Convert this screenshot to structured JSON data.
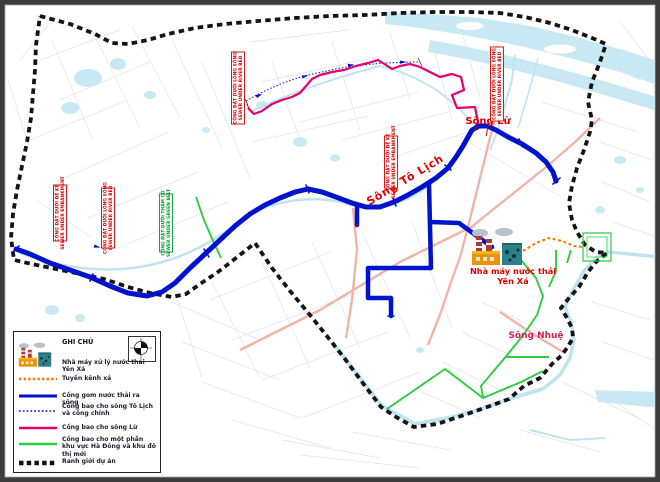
{
  "map": {
    "labels": {
      "song_to_lich": "Sông Tô Lịch",
      "song_lu": "Sông Lừ",
      "song_nhue": "Sông Nhuệ",
      "plant_line1": "Nhà máy nước thải",
      "plant_line2": "Yên Xá"
    },
    "annotations": [
      {
        "line1": "CỐNG ĐẶT DƯỚI LÒNG SÔNG",
        "line2": "SEWER UNDER RIVER BED",
        "color": "red"
      },
      {
        "line1": "CỐNG ĐẶT DƯỚI ĐÊ KÈ",
        "line2": "SEWER UNDER EMBANKMENT",
        "color": "red"
      },
      {
        "line1": "CỐNG ĐẶT DƯỚI LÒNG SÔNG",
        "line2": "SEWER UNDER RIVER BED",
        "color": "red"
      },
      {
        "line1": "CỐNG ĐẶT DƯỚI THẢM CỎ",
        "line2": "SEWER UNDER GREEN BELT",
        "color": "green"
      },
      {
        "line1": "CỐNG ĐẶT DƯỚI ĐÊ KÈ",
        "line2": "SEWER UNDER EMBANKMENT",
        "color": "red"
      },
      {
        "line1": "CỐNG ĐẶT DƯỚI LÒNG SÔNG",
        "line2": "SEWER UNDER RIVER BED",
        "color": "red"
      }
    ],
    "colors": {
      "main_sewer": "#0013cc",
      "lu_interceptor": "#e5006e",
      "green_interceptor": "#2ecc40",
      "discharge_channel": "#ff7300",
      "project_boundary": "#141414",
      "river_label": "#e20000",
      "nhue_label": "#cc2255",
      "water": "#c8e9f4",
      "major_road": "#f0b3aa"
    }
  },
  "legend": {
    "title": "GHI CHÚ",
    "items": [
      {
        "key": "plant",
        "label": "Nhà máy xử lý nước thải Yên Xá"
      },
      {
        "key": "discharge-channel",
        "label": "Tuyến kênh xả"
      },
      {
        "key": "main-sewer",
        "label": "Cống gom nước thải ra sông"
      },
      {
        "key": "to-lich-interceptor",
        "label": "Cống bao cho sông Tô Lịch và cống chính"
      },
      {
        "key": "lu-interceptor",
        "label": "Cống bao cho sông Lừ"
      },
      {
        "key": "green-interceptor",
        "label": "Cống bao cho một phần khu vực Hà Đông và khu đô thị mới"
      },
      {
        "key": "project-boundary",
        "label": "Ranh giới dự án"
      }
    ],
    "compass_icon": "north-compass"
  }
}
